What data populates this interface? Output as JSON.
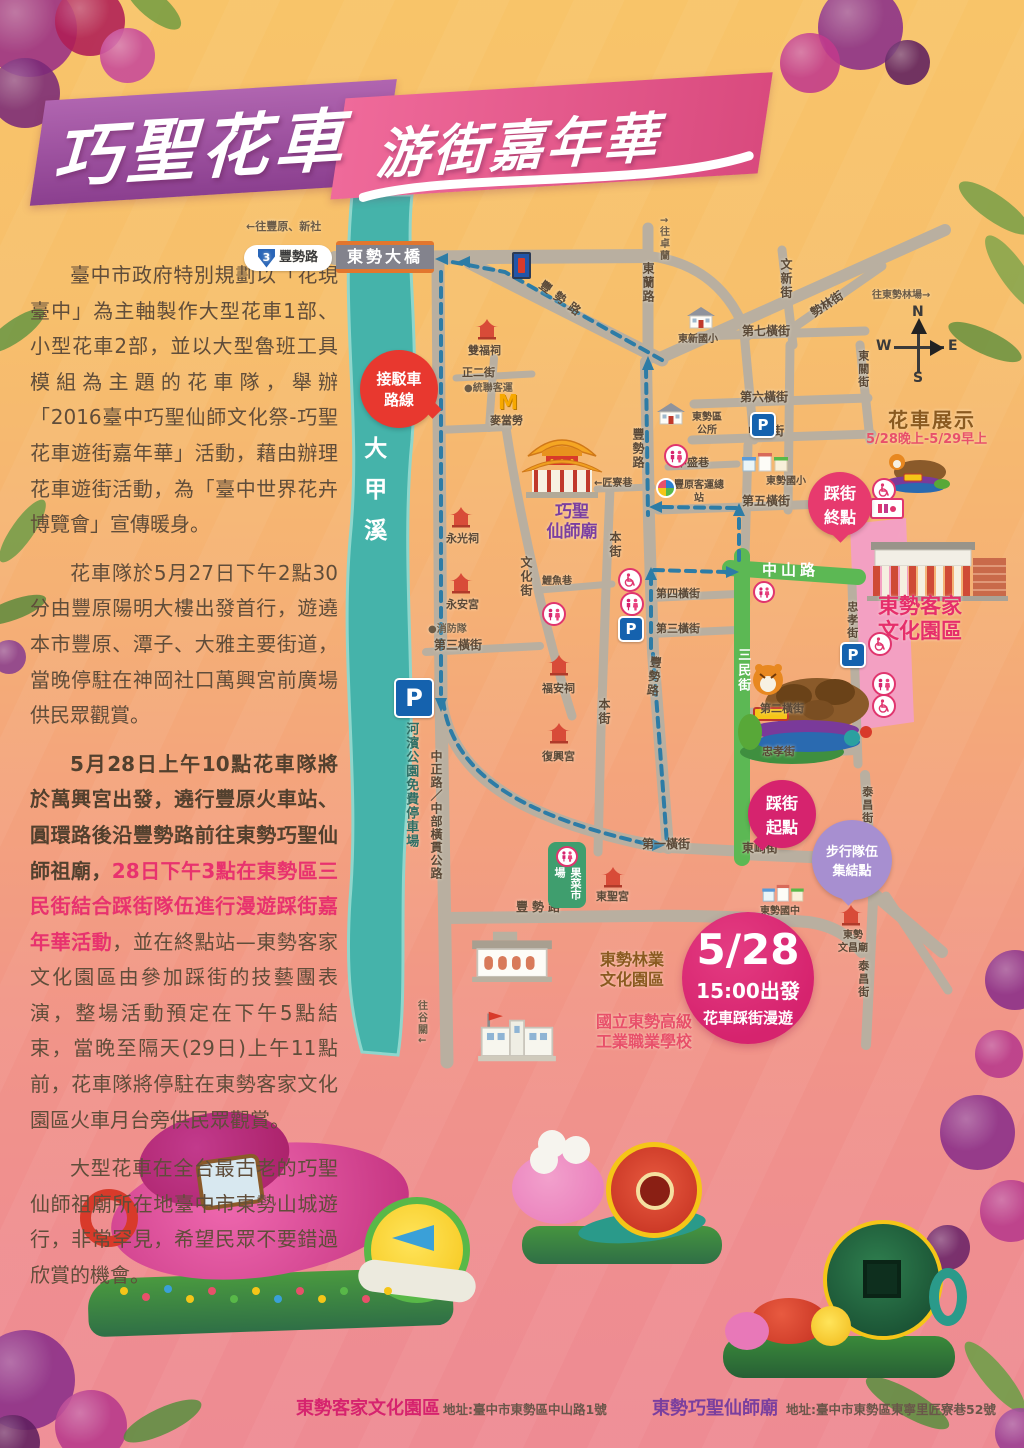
{
  "poster": {
    "title": {
      "main": "巧聖花車",
      "sub": "游街嘉年華"
    },
    "article": {
      "p1": "臺中市政府特別規劃以「花現臺中」為主軸製作大型花車1部、小型花車2部，並以大型魯班工具模組為主題的花車隊，舉辦「2016臺中巧聖仙師文化祭-巧聖花車遊街嘉年華」活動，藉由辦理花車遊街活動，為「臺中世界花卉博覽會」宣傳暖身。",
      "p2": "花車隊於5月27日下午2點30分由豐原陽明大樓出發首行，遊遶本市豐原、潭子、大雅主要街道，當晚停駐在神岡社口萬興宮前廣場供民眾觀賞。",
      "p3a": "5月28日上午10點花車隊將於萬興宮出發，遶行豐原火車站、圓環路後沿豐勢路前往東勢巧聖仙師祖廟，",
      "p3b": "28日下午3點在東勢區三民街結合踩街隊伍進行漫遊踩街嘉年華活動",
      "p3c": "，並在終點站—東勢客家文化園區由參加踩街的技藝團表演，整場活動預定在下午5點結束，當晚至隔天(29日)上午11點前，花車隊將停駐在東勢客家文化園區火車月台旁供民眾觀賞。",
      "p4": "大型花車在全台最古老的巧聖仙師祖廟所在地臺中市東勢山城遊行，非常罕見，希望民眾不要錯過欣賞的機會。"
    },
    "map": {
      "notes": {
        "to_fengyuan": "←往豐原、新社",
        "to_zhuolan": "↑往卓蘭",
        "to_forest": "往東勢林場→",
        "to_guguan": "往谷關↓",
        "bridge": "東勢大橋",
        "route_no": "3",
        "river": "大甲溪",
        "riverside_parking": "河濱公園免費停車場",
        "parking": "P"
      },
      "compass": {
        "n": "N",
        "e": "E",
        "s": "S",
        "w": "W"
      },
      "streets": {
        "fengshi": "豐勢路",
        "donglan": "東蘭路",
        "wenxin": "文新街",
        "shilin": "勢林街",
        "hengjie7": "第七橫街",
        "dongguan": "東關街",
        "hengjie6": "第六橫街",
        "zhongxing": "中興街",
        "zhenger": "正二街",
        "zhongsheng": "中盛巷",
        "hengjie5": "第五橫街",
        "jiangliao": "←匠寮巷",
        "benjie": "本街",
        "wenhuajie": "文化街",
        "liyu": "鯉魚巷",
        "hengjie4": "第四橫街",
        "hengjie3": "第三橫街",
        "hengjie2": "第二橫街",
        "hengjie1": "第一橫街",
        "zhongshan": "中山路",
        "sanmin": "三民街",
        "zhongxiao": "忠孝街",
        "dongqi": "東崎街",
        "taichang": "泰昌街",
        "zhongzheng": "中正路／中部橫貫公路"
      },
      "landmarks": {
        "qiaosheng_1": "巧聖",
        "qiaosheng_2": "仙師廟",
        "shuangfu": "雙福祠",
        "tonglian": "●統聯客運",
        "mcdonalds": "麥當勞",
        "mcdonalds_m": "M",
        "dongxin": "東新國小",
        "office": "東勢區公所",
        "busstation": "豐原客運總站",
        "dongshi_es": "東勢國小",
        "yongguang": "永光祠",
        "yongan": "永安宮",
        "fire": "●消防隊",
        "fuan": "福安祠",
        "fuxing": "復興宮",
        "hakka": "東勢客家文化園區",
        "market": "果菜市場",
        "dongshenggong": "東聖宮",
        "forestry": "東勢林業文化園區",
        "vocational": "國立東勢高級工業職業學校",
        "junior": "東勢國中",
        "wenchang_1": "東勢",
        "wenchang_2": "文昌廟"
      },
      "bubbles": {
        "shuttle": "接駁車路線",
        "end": "踩街終點",
        "start": "踩街起點",
        "walk": "步行隊伍集結點"
      },
      "exhibit": {
        "title": "花車展示",
        "time": "5/28晚上-5/29早上"
      },
      "event": {
        "date": "5/28",
        "depart": "15:00出發",
        "desc": "花車踩街漫遊"
      }
    },
    "footer": {
      "v1_name": "東勢客家文化園區",
      "v1_addr": "地址:臺中市東勢區中山路1號",
      "v2_name": "東勢巧聖仙師廟",
      "v2_addr": "地址:臺中市東勢區東寧里匠寮巷52號"
    },
    "colors": {
      "accent_magenta": "#d6236e",
      "accent_purple": "#8e4a9e",
      "route_blue": "#2d7ca6",
      "road_green": "#5cb854",
      "river_teal": "#45b3aa"
    }
  }
}
